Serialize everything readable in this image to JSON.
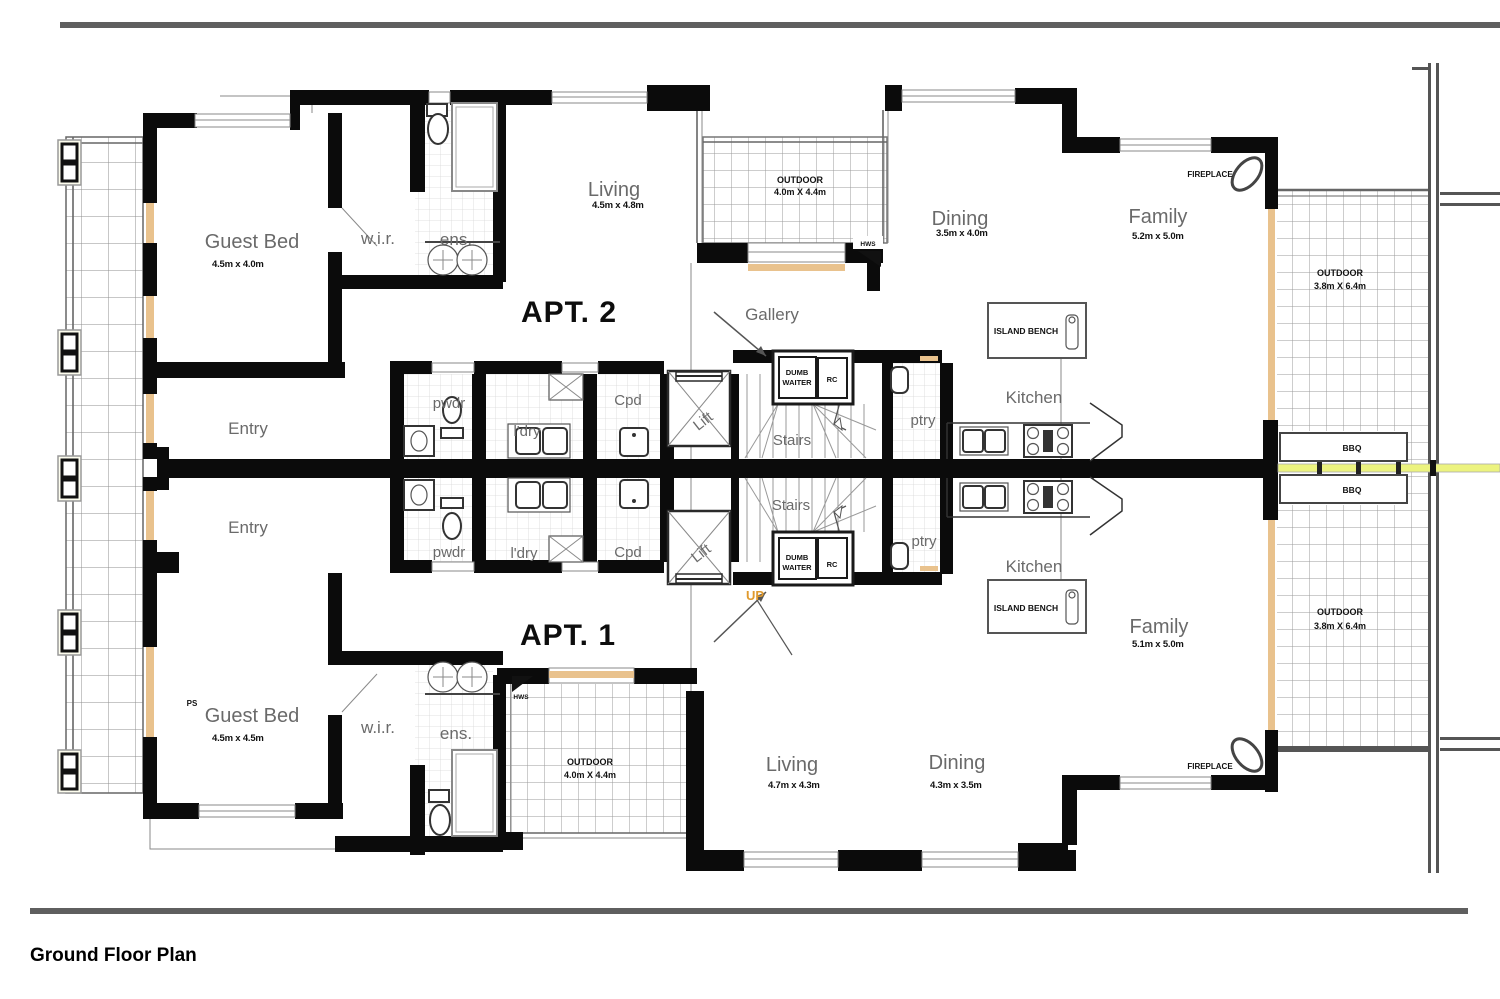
{
  "title": "Ground Floor Plan",
  "apt2": {
    "name": "APT. 2",
    "entry": "Entry",
    "guest_bed": {
      "label": "Guest Bed",
      "dims": "4.5m x 4.0m"
    },
    "wir": "w.i.r.",
    "ens": "ens.",
    "living": {
      "label": "Living",
      "dims": "4.5m x 4.8m"
    },
    "outdoor": {
      "label": "OUTDOOR",
      "dims": "4.0m X 4.4m"
    },
    "gallery": "Gallery",
    "dining": {
      "label": "Dining",
      "dims": "3.5m x 4.0m"
    },
    "family": {
      "label": "Family",
      "dims": "5.2m x 5.0m"
    },
    "fireplace": "FIREPLACE",
    "outdoor_side": {
      "label": "OUTDOOR",
      "dims": "3.8m X 6.4m"
    },
    "hws": "HWS",
    "pwdr": "pwdr",
    "ldry": "l'dry",
    "cpd": "Cpd",
    "lift": "Lift",
    "stairs": "Stairs",
    "dumb_waiter": {
      "line1": "DUMB",
      "line2": "WAITER"
    },
    "rc": "RC",
    "ptry": "ptry",
    "kitchen": "Kitchen",
    "island_bench": "ISLAND BENCH"
  },
  "apt1": {
    "name": "APT. 1",
    "entry": "Entry",
    "ps": "PS",
    "guest_bed": {
      "label": "Guest Bed",
      "dims": "4.5m x 4.5m"
    },
    "wir": "w.i.r.",
    "ens": "ens.",
    "living": {
      "label": "Living",
      "dims": "4.7m x 4.3m"
    },
    "outdoor": {
      "label": "OUTDOOR",
      "dims": "4.0m X 4.4m"
    },
    "dining": {
      "label": "Dining",
      "dims": "4.3m x 3.5m"
    },
    "family": {
      "label": "Family",
      "dims": "5.1m x 5.0m"
    },
    "fireplace": "FIREPLACE",
    "outdoor_side": {
      "label": "OUTDOOR",
      "dims": "3.8m X 6.4m"
    },
    "hws": "HWS",
    "up": "UP",
    "pwdr": "pwdr",
    "ldry": "l'dry",
    "cpd": "Cpd",
    "lift": "Lift",
    "stairs": "Stairs",
    "dumb_waiter": {
      "line1": "DUMB",
      "line2": "WAITER"
    },
    "rc": "RC",
    "ptry": "ptry",
    "kitchen": "Kitchen",
    "island_bench": "ISLAND BENCH"
  },
  "shared": {
    "bbq": "BBQ"
  },
  "colors": {
    "wall": "#0b0b0b",
    "border_line": "#5f5f5f",
    "glazing_orange": "#e9c28d",
    "bbq_line": "#ecf37f",
    "up_orange": "#e09a2d",
    "label_gray": "#6a6a6a"
  }
}
